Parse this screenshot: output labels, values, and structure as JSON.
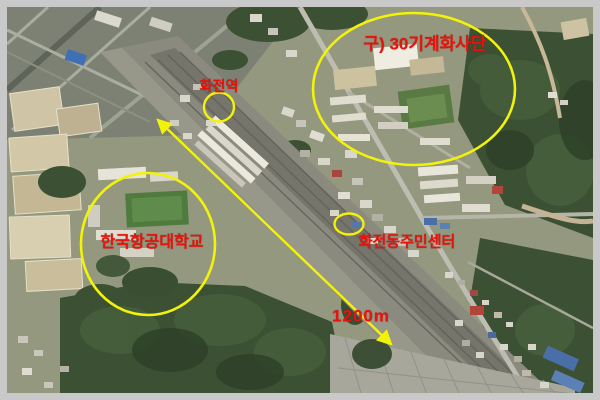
{
  "figure": {
    "annotations": {
      "division": "구) 30기계화사단",
      "station": "화전역",
      "university": "한국항공대학교",
      "community_center": "화전동주민센터",
      "distance": "1200m"
    },
    "colors": {
      "highlight_yellow": "#f2f20a",
      "label_red": "#ea120b",
      "frame_gray": "#c9c9c9"
    }
  }
}
